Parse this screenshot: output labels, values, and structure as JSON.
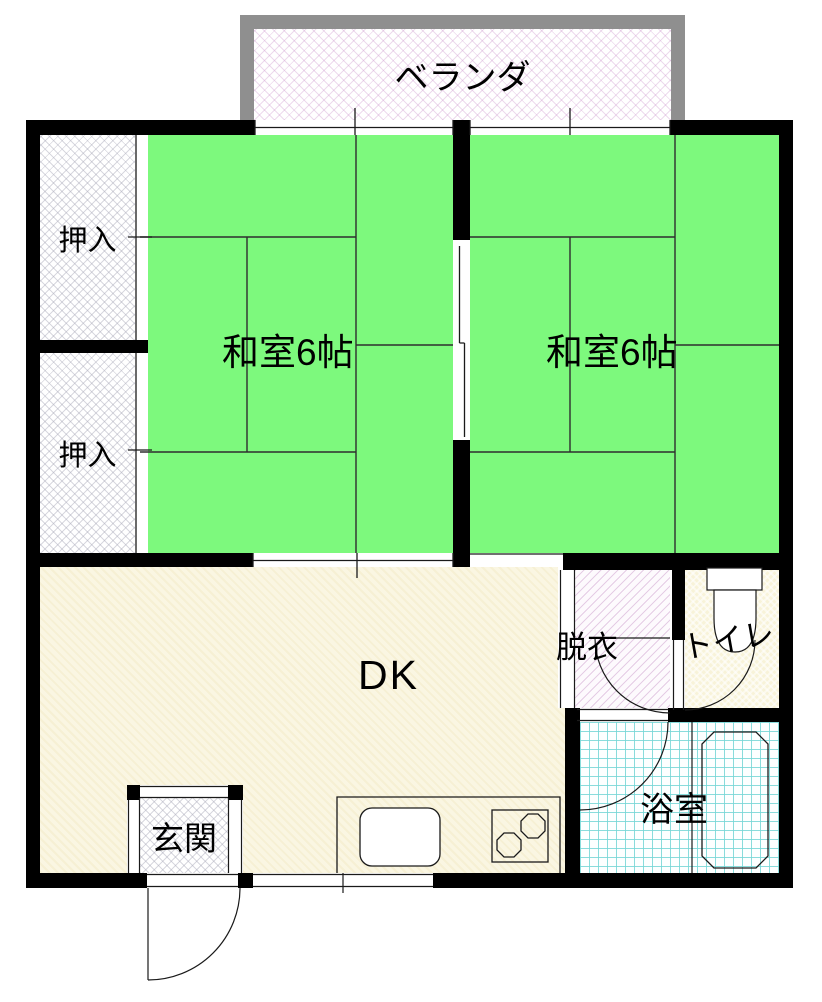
{
  "plan": {
    "kind": "apartment-floor-plan",
    "labels": {
      "veranda": "ベランダ",
      "closet_upper": "押入",
      "closet_lower": "押入",
      "washitsu_left": "和室6帖",
      "washitsu_right": "和室6帖",
      "dining_kitchen": "DK",
      "dressing_room": "脱衣",
      "toilet": "トイレ",
      "bathroom": "浴室",
      "entrance": "玄関"
    },
    "colors": {
      "tatami_green": "#7df97d",
      "dk_cream": "#faf6e2",
      "toilet_cream": "#f8f3d9",
      "bath_grid_cyan": "#76d6d6",
      "wall_black": "#000000",
      "veranda_frame_gray": "#8f8f8f",
      "dressing_hatch_pink": "#cc96cc",
      "closet_hatch_gray": "#a8a8b8"
    }
  }
}
